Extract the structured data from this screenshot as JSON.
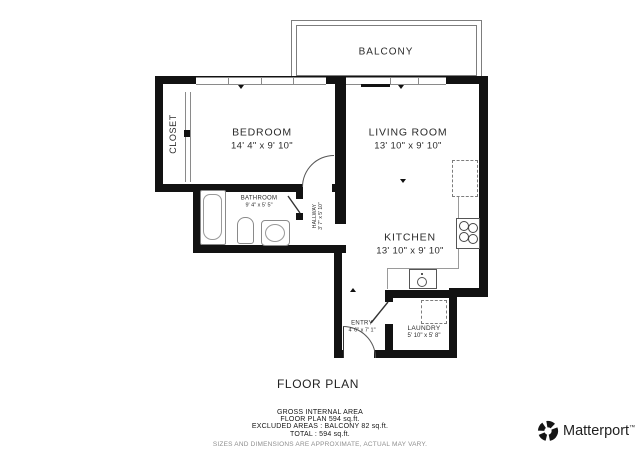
{
  "colors": {
    "wall": "#121212",
    "fixture_line": "#8a8a8a",
    "text": "#2b2b2b",
    "muted": "#8f8f8f"
  },
  "plan": {
    "title": "FLOOR PLAN",
    "rooms": {
      "balcony": {
        "name": "BALCONY"
      },
      "closet": {
        "name": "CLOSET"
      },
      "bedroom": {
        "name": "BEDROOM",
        "dims": "14' 4\" x 9' 10\""
      },
      "living_room": {
        "name": "LIVING ROOM",
        "dims": "13' 10\" x 9' 10\""
      },
      "bathroom": {
        "name": "BATHROOM",
        "dims": "9' 4\" x 5' 5\""
      },
      "hallway": {
        "name": "HALLWAY",
        "dims": "3' 7\" x 5' 10\""
      },
      "kitchen": {
        "name": "KITCHEN",
        "dims": "13' 10\" x 9' 10\""
      },
      "entry": {
        "name": "ENTRY",
        "dims": "4' 6\" x 7' 1\""
      },
      "laundry": {
        "name": "LAUNDRY",
        "dims": "5' 10\" x 5' 8\""
      }
    },
    "fixtures": [
      "bathtub",
      "pedestal-sink",
      "toilet",
      "refrigerator",
      "stove",
      "kitchen-sink",
      "washer"
    ]
  },
  "footer": {
    "area_title": "GROSS INTERNAL AREA",
    "area_line1": "FLOOR PLAN 594 sq.ft.",
    "area_line2": "EXCLUDED AREAS : BALCONY 82 sq.ft.",
    "area_line3": "TOTAL : 594 sq.ft.",
    "disclaimer": "SIZES AND DIMENSIONS ARE APPROXIMATE, ACTUAL MAY VARY."
  },
  "branding": {
    "name": "Matterport",
    "trademark": "™"
  }
}
